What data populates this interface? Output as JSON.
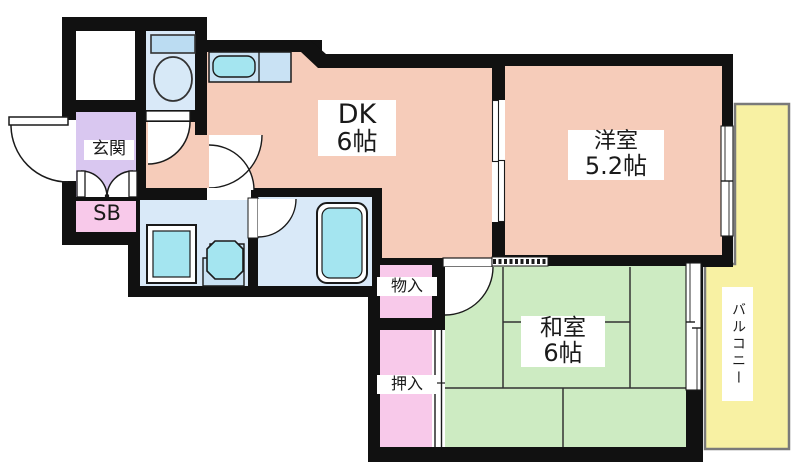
{
  "rooms": {
    "dk": {
      "label": "DK",
      "size": "6帖"
    },
    "western": {
      "label": "洋室",
      "size": "5.2帖"
    },
    "japanese": {
      "label": "和室",
      "size": "6帖"
    },
    "entrance": {
      "label": "玄関"
    },
    "shoe_box": {
      "label": "SB"
    },
    "storage": {
      "label": "物入"
    },
    "closet": {
      "label": "押入"
    },
    "balcony": {
      "label": "バルコニー"
    }
  },
  "colors": {
    "wall": "#111111",
    "room-salmon": "#F6CCBA",
    "room-green": "#CDEBC2",
    "room-yellow": "#F8F1A3",
    "room-purple": "#D9C7F0",
    "room-pink": "#F8C9EA",
    "room-blue": "#D9E9F8",
    "fixture-cyan": "#A4E5F0",
    "counter-blue": "#C9E2F4",
    "balcony-border": "#7a7a7a",
    "tatami-line": "#333333"
  }
}
